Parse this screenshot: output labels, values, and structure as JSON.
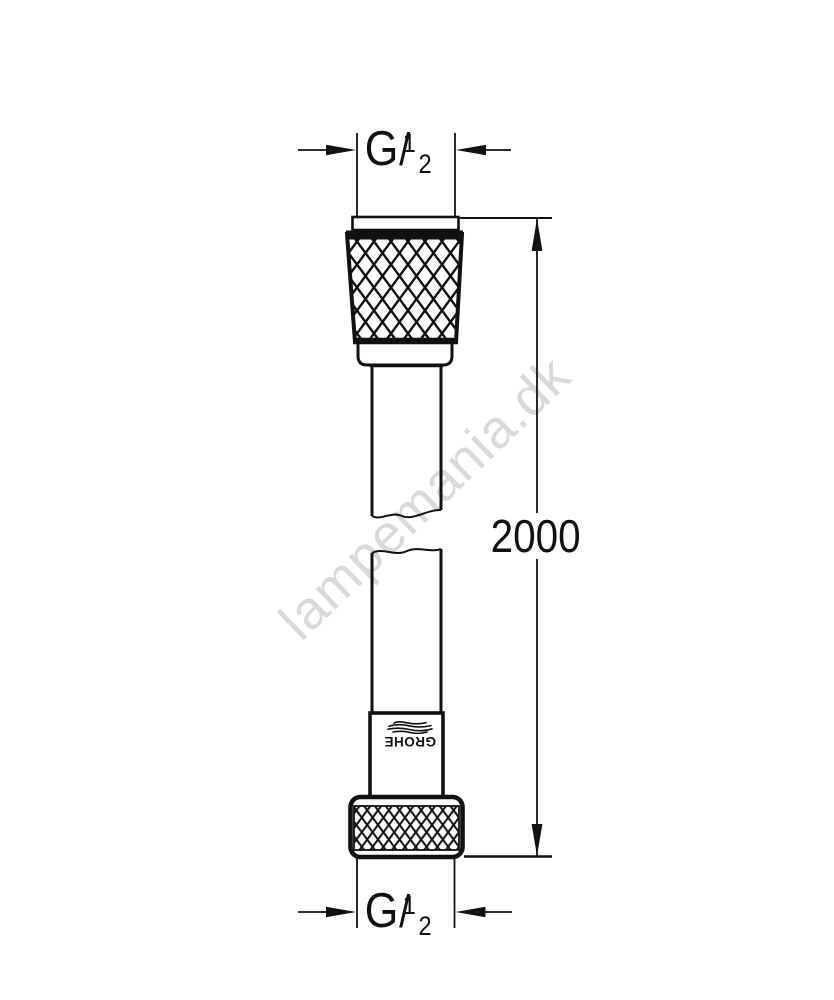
{
  "drawing": {
    "watermark": "lampemania.dk",
    "length_label": "2000",
    "thread_top": {
      "letter": "G",
      "numerator": "1",
      "slash": "/",
      "denominator": "2"
    },
    "thread_bottom": {
      "letter": "G",
      "numerator": "1",
      "slash": "/",
      "denominator": "2"
    },
    "brand": "GROHE"
  },
  "colors": {
    "line": "#111111",
    "watermark": "#d9d9d9",
    "background": "#ffffff"
  }
}
